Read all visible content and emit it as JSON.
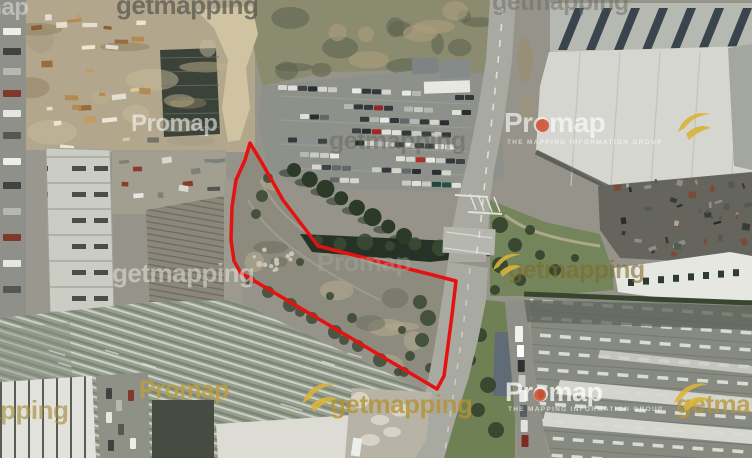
{
  "page": {
    "description": "Aerial photograph of an industrial estate with a development site outlined in red"
  },
  "watermarks": {
    "getmapping_label": "getmapping",
    "promap_label": "Promap",
    "promap_tagline": "THE MAPPING INFORMATION GROUP"
  },
  "branding": {
    "swoosh_color": "#d8b23c",
    "promap_dot_color": "#cf4a28"
  },
  "site_boundary": {
    "stroke_color": "#e51212",
    "stroke_width": 3.5,
    "points": [
      [
        250,
        143
      ],
      [
        262,
        163
      ],
      [
        283,
        200
      ],
      [
        318,
        246
      ],
      [
        373,
        260
      ],
      [
        429,
        274
      ],
      [
        456,
        281
      ],
      [
        452,
        315
      ],
      [
        444,
        376
      ],
      [
        437,
        389
      ],
      [
        241,
        273
      ],
      [
        234,
        261
      ],
      [
        231,
        240
      ],
      [
        232,
        207
      ],
      [
        236,
        180
      ],
      [
        245,
        160
      ]
    ]
  }
}
